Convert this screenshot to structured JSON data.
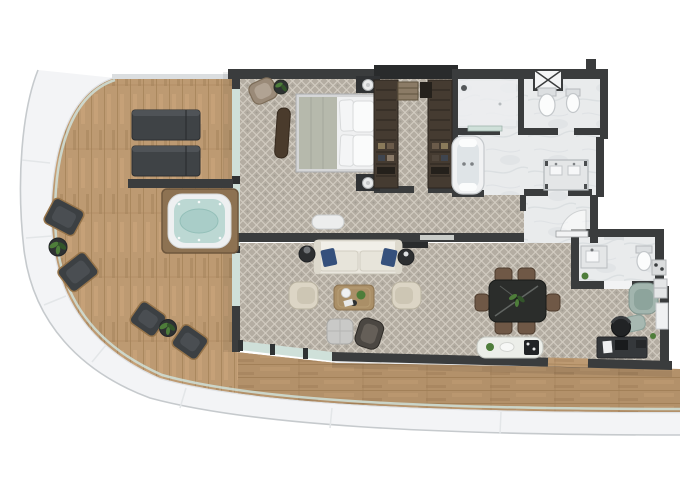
{
  "scene": {
    "type": "floor-plan",
    "description": "Top-down rendered floor plan of a luxury suite with curved wrap-around wooden terrace"
  },
  "rooms": [
    {
      "id": "terrace",
      "floor": "wood-deck",
      "items": [
        "sun-lounger",
        "sun-lounger",
        "hot-tub",
        "privacy-wall",
        "outdoor-chair",
        "plant-side-table",
        "outdoor-chair",
        "outdoor-chair",
        "plant-side-table",
        "outdoor-chair"
      ]
    },
    {
      "id": "bedroom",
      "floor": "patterned-carpet",
      "items": [
        "king-bed",
        "headboard",
        "nightstand-lamp",
        "nightstand-lamp",
        "corner-armchair",
        "plant-side-table",
        "chaise-bench",
        "foot-bench"
      ]
    },
    {
      "id": "walk-in-closet",
      "floor": "patterned-carpet",
      "items": [
        "wardrobe",
        "wardrobe",
        "luggage-bench",
        "cabinet"
      ]
    },
    {
      "id": "master-bathroom",
      "floor": "marble",
      "items": [
        "bathtub",
        "shower",
        "toilet",
        "bidet",
        "vanity-console",
        "service-shaft"
      ]
    },
    {
      "id": "entry-hall",
      "floor": "marble",
      "items": [
        "entry-door"
      ]
    },
    {
      "id": "guest-bathroom",
      "floor": "marble",
      "items": [
        "vanity-sink",
        "toilet",
        "plant",
        "door"
      ]
    },
    {
      "id": "living-room",
      "floor": "patterned-carpet",
      "items": [
        "tv-console",
        "sofa",
        "end-table-lamp",
        "end-table-lamp",
        "armchair",
        "armchair",
        "coffee-table",
        "ottoman",
        "accent-chair",
        "glass-balustrade"
      ]
    },
    {
      "id": "dining-area",
      "floor": "patterned-carpet",
      "items": [
        "dining-table",
        "dining-chair",
        "dining-chair",
        "dining-chair",
        "dining-chair",
        "dining-chair",
        "dining-chair",
        "credenza"
      ]
    },
    {
      "id": "study-corner",
      "floor": "patterned-carpet",
      "items": [
        "desk",
        "desk-chair",
        "lounge-chair",
        "ottoman",
        "minibar-cabinet",
        "shelf-unit"
      ]
    }
  ],
  "colors": {
    "bg": "#ffffff",
    "hull": "#f3f4f6",
    "hull_edge": "#c6cacd",
    "hull_shade": "#dde0e3",
    "deck": "#bd9a72",
    "deck_seam": "#a5825a",
    "deck_light": "#cfa87e",
    "deck_dark": "#9d7c55",
    "carpet": "#b4ada2",
    "carpet_line": "#d3cdc2",
    "carpet_dot": "#8f897f",
    "marble": "#e9ebec",
    "marble_vein": "#d0d5d9",
    "wall": "#3a3c3d",
    "wall_dark": "#292b2c",
    "glass": "#cfe0d9",
    "glass_post": "#2f3233",
    "tub_frame": "#8d7252",
    "tub_shell": "#eef0f1",
    "water": "#bcd8d3",
    "water_deep": "#a9cdc8",
    "lounger": "#3f4346",
    "lounger_light": "#54585b",
    "outdoor_chair": "#3c4043",
    "chair_frame": "#96744a",
    "side_table_dark": "#2e3132",
    "bed_frame": "#d5d6d7",
    "bed_white": "#eff0f1",
    "bed_throw": "#b6b9ac",
    "headboard": "#2c2e31",
    "lamp": "#e9eaeb",
    "closet": "#453b31",
    "closet_line": "#2c251e",
    "closet_box": "#8b7b66",
    "armchair_taupe": "#9a8a78",
    "sofa": "#e9e6dd",
    "sofa_cushion": "#e7e4da",
    "pillow_blue": "#35507c",
    "armchair": "#dcd5c5",
    "armchair_seat": "#cdc6b4",
    "coffee": "#aa8f67",
    "ottoman": "#c9c9c7",
    "accent_chair": "#4b4742",
    "accent_seat": "#655f58",
    "dining_table": "#2b2d2b",
    "dining_chair": "#6f5846",
    "credenza": "#eceee9",
    "desk": "#35383b",
    "desk_chair": "#212325",
    "teal": "#a2b5ae",
    "teal_seat": "#8da49c",
    "plant": "#4e7d3a",
    "plant_dark": "#33552a",
    "fixture": "#e4e6e7",
    "white": "#fbfcfc",
    "door_leaf": "#f2f3f4"
  }
}
